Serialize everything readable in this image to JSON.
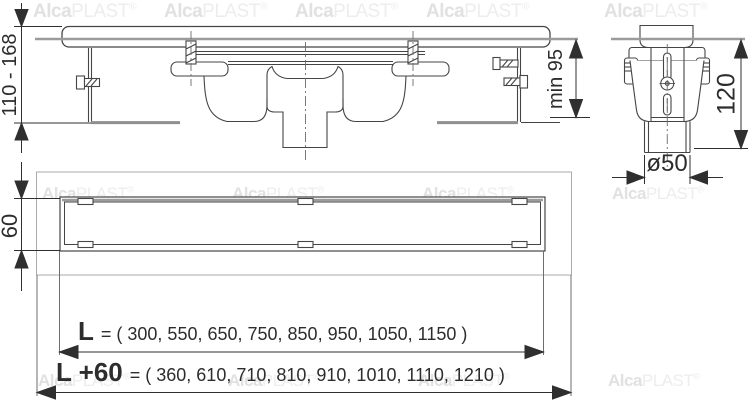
{
  "watermark": {
    "alca": "Alca",
    "plast": "PLAST",
    "reg": "®"
  },
  "dimensions": {
    "installation_height": "110 - 168",
    "min_installation_depth": "min 95",
    "channel_width": "60",
    "trap_height": "120",
    "outlet_diameter": "ø50",
    "length_grate": {
      "label": "L",
      "value": "= ( 300, 550, 650, 750, 850, 950, 1050, 1150 )"
    },
    "length_total": {
      "label": "L +60",
      "value": "= ( 360, 610, 710, 810, 910, 1010, 1110, 1210 )"
    }
  }
}
